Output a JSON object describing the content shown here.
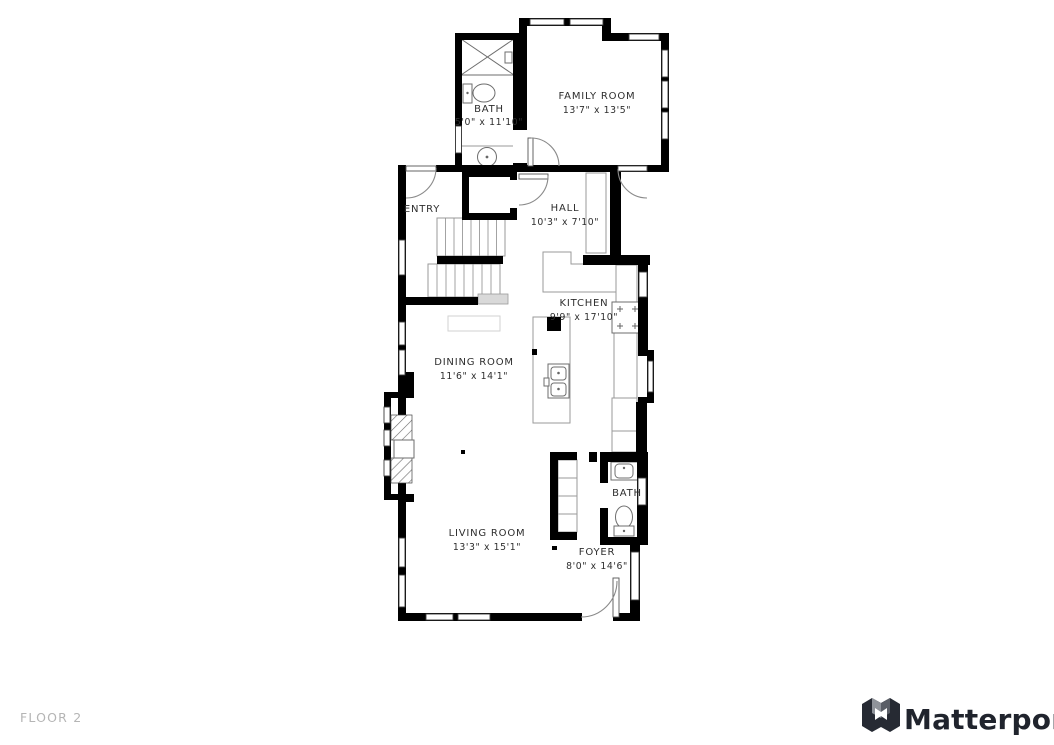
{
  "floor_plan": {
    "rooms": [
      {
        "id": "bath-upper",
        "name": "BATH",
        "dims": "5'0\" x 11'10\""
      },
      {
        "id": "family-room",
        "name": "FAMILY ROOM",
        "dims": "13'7\" x 13'5\""
      },
      {
        "id": "hall",
        "name": "HALL",
        "dims": "10'3\" x 7'10\""
      },
      {
        "id": "entry",
        "name": "ENTRY",
        "dims": ""
      },
      {
        "id": "kitchen",
        "name": "KITCHEN",
        "dims": "9'9\" x 17'10\""
      },
      {
        "id": "dining-room",
        "name": "DINING ROOM",
        "dims": "11'6\" x 14'1\""
      },
      {
        "id": "living-room",
        "name": "LIVING ROOM",
        "dims": "13'3\" x 15'1\""
      },
      {
        "id": "bath-lower",
        "name": "BATH",
        "dims": ""
      },
      {
        "id": "foyer",
        "name": "FOYER",
        "dims": "8'0\" x 14'6\""
      }
    ],
    "fixtures": [
      "shower",
      "toilet",
      "sink",
      "staircase",
      "kitchen-island",
      "range",
      "fireplace",
      "closet"
    ]
  },
  "footer": {
    "floor_label": "FLOOR 2"
  },
  "brand": {
    "name": "Matterport"
  },
  "colors": {
    "walls": "#000000",
    "background": "#ffffff",
    "label_text": "#2e2e2e",
    "floor_label_text": "#b5b5b5",
    "furniture_outline": "#9a9a9a",
    "brand_text": "#20242d"
  }
}
